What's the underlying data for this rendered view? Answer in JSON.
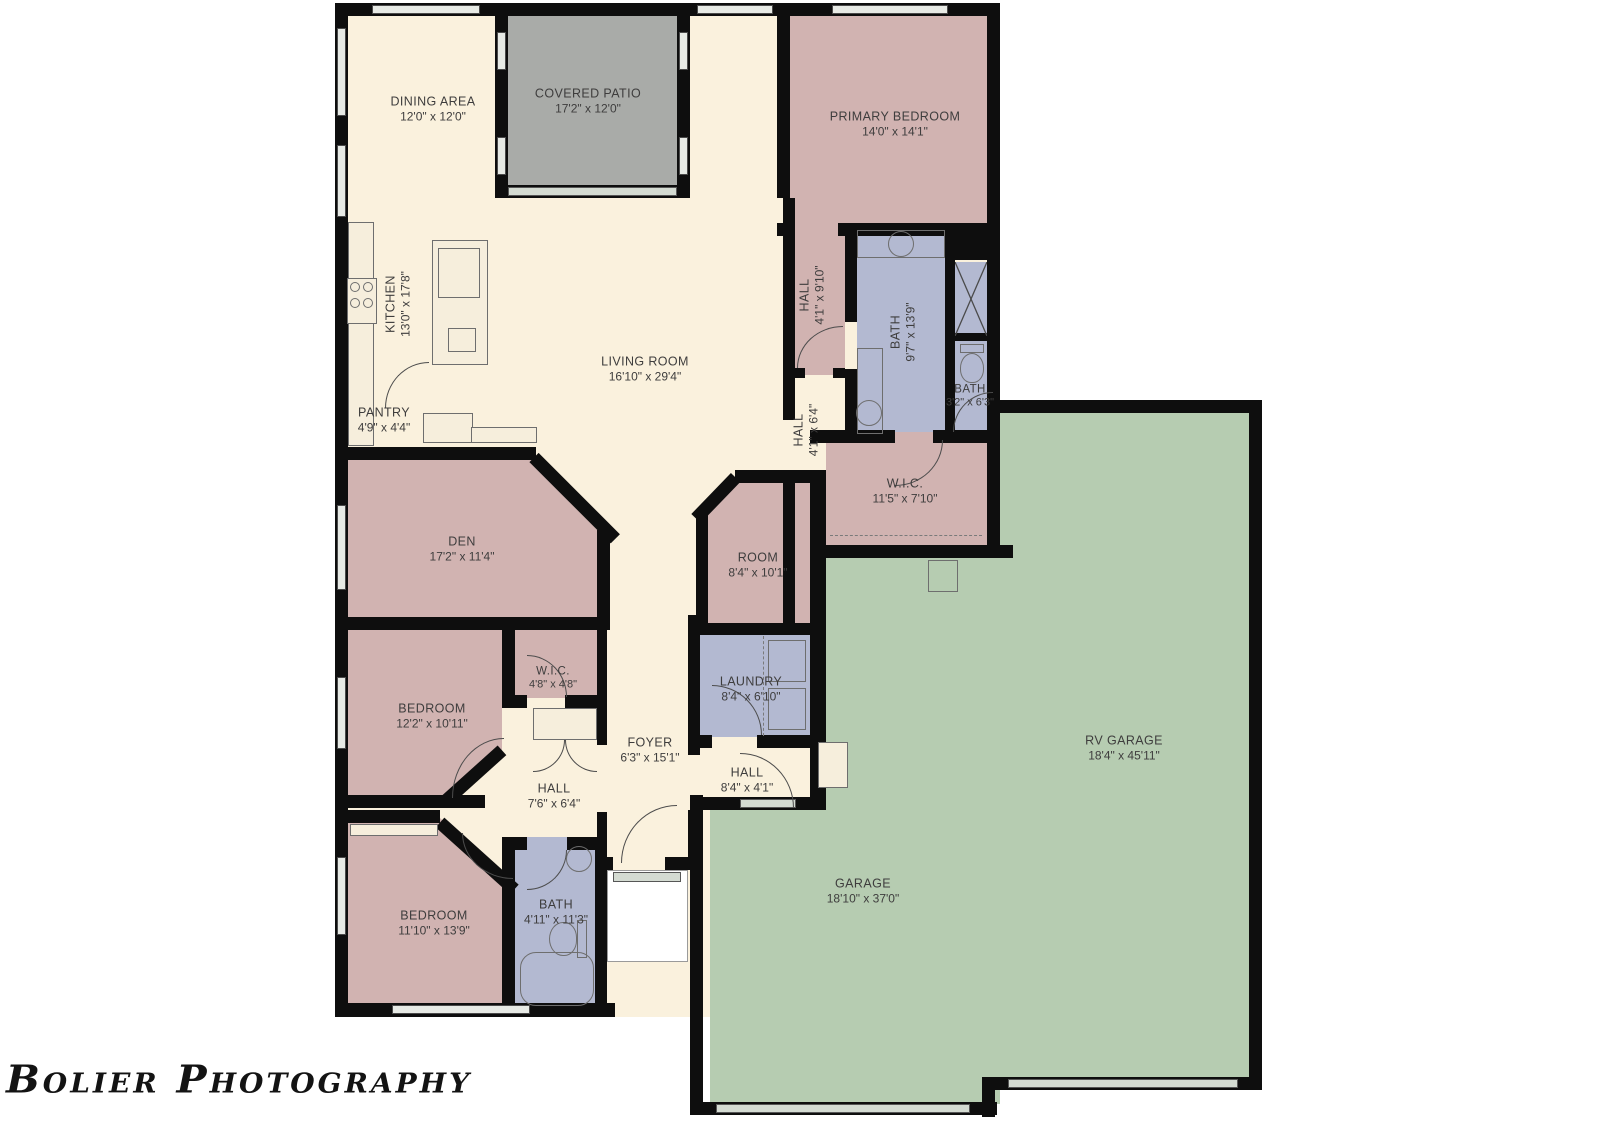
{
  "watermark": "Bolier Photography",
  "palette": {
    "floor_cream": "#faf1dd",
    "bedroom_pink": "#d1b3b1",
    "bath_blue": "#b3b9d1",
    "patio_gray": "#a9aba8",
    "garage_green": "#b6ccb1",
    "wall_black": "#0e0e0e",
    "label_gray": "#3e3d3d"
  },
  "rooms": [
    {
      "id": "dining-area",
      "name": "DINING AREA",
      "dims": "12'0\" x 12'0\""
    },
    {
      "id": "covered-patio",
      "name": "COVERED PATIO",
      "dims": "17'2\" x 12'0\""
    },
    {
      "id": "primary-bedroom",
      "name": "PRIMARY BEDROOM",
      "dims": "14'0\" x 14'1\""
    },
    {
      "id": "kitchen",
      "name": "KITCHEN",
      "dims": "13'0\" x 17'8\""
    },
    {
      "id": "living-room",
      "name": "LIVING ROOM",
      "dims": "16'10\" x 29'4\""
    },
    {
      "id": "pantry",
      "name": "PANTRY",
      "dims": "4'9\" x 4'4\""
    },
    {
      "id": "hall-primary",
      "name": "HALL",
      "dims": "4'1\" x 9'10\""
    },
    {
      "id": "bath-primary",
      "name": "BATH",
      "dims": "9'7\" x 13'9\""
    },
    {
      "id": "bath-small",
      "name": "BATH",
      "dims": "3'2\" x 6'3\""
    },
    {
      "id": "hall-mid",
      "name": "HALL",
      "dims": "4'1\" x 6'4\""
    },
    {
      "id": "wic-primary",
      "name": "W.I.C.",
      "dims": "11'5\" x 7'10\""
    },
    {
      "id": "den",
      "name": "DEN",
      "dims": "17'2\" x 11'4\""
    },
    {
      "id": "room",
      "name": "ROOM",
      "dims": "8'4\" x 10'1\""
    },
    {
      "id": "rv-garage",
      "name": "RV GARAGE",
      "dims": "18'4\" x 45'11\""
    },
    {
      "id": "wic-small",
      "name": "W.I.C.",
      "dims": "4'8\" x 4'8\""
    },
    {
      "id": "bedroom-1",
      "name": "BEDROOM",
      "dims": "12'2\" x 10'11\""
    },
    {
      "id": "laundry",
      "name": "LAUNDRY",
      "dims": "8'4\" x 6'10\""
    },
    {
      "id": "foyer",
      "name": "FOYER",
      "dims": "6'3\" x 15'1\""
    },
    {
      "id": "hall-garage",
      "name": "HALL",
      "dims": "8'4\" x 4'1\""
    },
    {
      "id": "hall-bedrooms",
      "name": "HALL",
      "dims": "7'6\" x 6'4\""
    },
    {
      "id": "garage",
      "name": "GARAGE",
      "dims": "18'10\" x 37'0\""
    },
    {
      "id": "bedroom-2",
      "name": "BEDROOM",
      "dims": "11'10\" x 13'9\""
    },
    {
      "id": "bath-hall",
      "name": "BATH",
      "dims": "4'11\" x 11'3\""
    }
  ]
}
